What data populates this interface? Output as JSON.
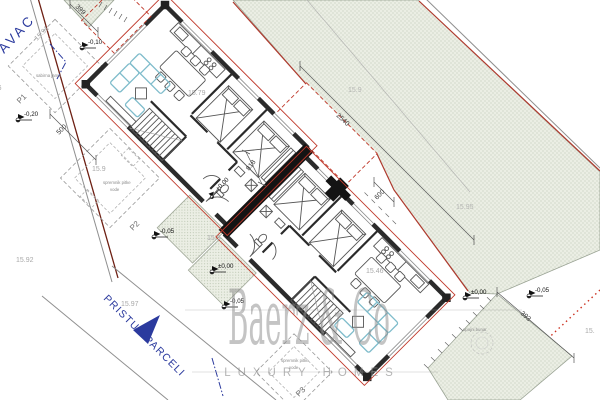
{
  "street": {
    "name_label": "AVAC"
  },
  "access": {
    "label": "PRISTUP PARCELI"
  },
  "watermark": {
    "brand": "Baerz & Co",
    "tagline": "LUXURY HOMES"
  },
  "parcel_labels": {
    "p1": "P1",
    "p2": "P2",
    "p3": "P3"
  },
  "utilities": {
    "sabirna_jama": "sabirna jama",
    "spremnik_1_line1": "spremnik pitke",
    "spremnik_1_line2": "vode",
    "spremnik_2_line1": "spremnik pitke",
    "spremnik_2_line2": "vode",
    "upojni_bunar": "upojni bunar"
  },
  "dimensions": {
    "d399": "399",
    "d500": "500",
    "d2540": "2540",
    "d818": "818",
    "d600": "600",
    "d393": "393"
  },
  "levels": {
    "l1": "-0,10",
    "l2": "-0,20",
    "l3": "-0,05",
    "l4": "±0,00",
    "l5": "-0,05",
    "l6": "±0,00",
    "l7": "-0,05",
    "l8": "+0,00"
  },
  "spot_heights": {
    "s1": "15.91",
    "s2": "15.79",
    "s3": "15.9",
    "s4": "15.92",
    "s5": "15.97",
    "s6": "15.9",
    "s7": "15.46",
    "s8": "15.9",
    "s9": "15.95",
    "s10": "15.86",
    "s11": "15."
  },
  "colors": {
    "outdoor_green": "#ebeee4",
    "green_dot": "#b3bfa9",
    "accent_red": "#c0392b",
    "boundary_dark_red": "#6e2014",
    "boundary_gray": "#8f8f8f",
    "dotted_red": "#cc3322",
    "furniture_cyan": "#7fbccb",
    "label_blue": "#2b3a9e",
    "spot_gray": "#a9a9a9",
    "wall_dark": "#2b2b2b"
  }
}
